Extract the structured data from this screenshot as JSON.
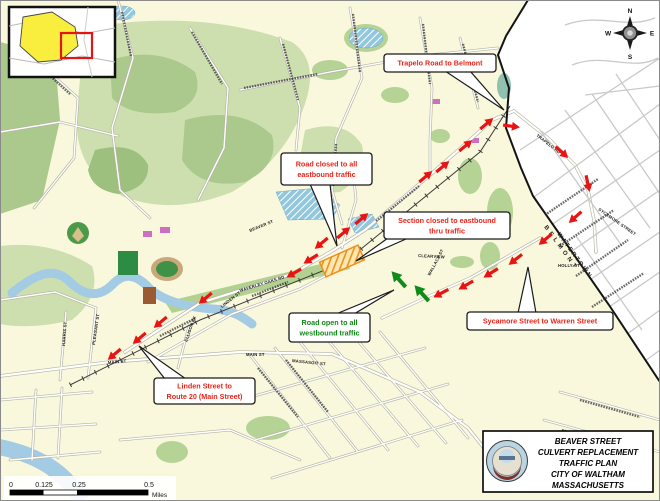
{
  "colors": {
    "land": "#faf8dc",
    "belmont": "#ffffff",
    "water": "#a3cbe3",
    "arrow_red": "#e81414",
    "arrow_green": "#108a18",
    "callout_red": "#e8251a",
    "construction": "#ef8f1f"
  },
  "compass": {
    "n": "N",
    "e": "E",
    "s": "S",
    "w": "W"
  },
  "scale_bar": {
    "labels": [
      "0",
      "0.125",
      "0.25",
      "0.5"
    ],
    "unit": "Miles"
  },
  "title_block": {
    "lines": [
      "BEAVER STREET",
      "CULVERT REPLACEMENT",
      "TRAFFIC PLAN",
      "CITY OF WALTHAM",
      "MASSACHUSETTS"
    ]
  },
  "region_labels": [
    {
      "t": "BELMONT",
      "x": 544,
      "y": 227,
      "r": 54,
      "ls": 3.5
    },
    {
      "t": "WATERTOWN",
      "x": 557,
      "y": 234,
      "r": 54,
      "ls": 1.8
    }
  ],
  "street_labels": [
    {
      "t": "BEAVER ST",
      "x": 250,
      "y": 232,
      "r": -22
    },
    {
      "t": "WAVERLEY OAKS RD",
      "x": 240,
      "y": 292,
      "r": -17
    },
    {
      "t": "MAIN ST",
      "x": 108,
      "y": 364,
      "r": -5
    },
    {
      "t": "MAIN ST",
      "x": 246,
      "y": 356,
      "r": 0
    },
    {
      "t": "MASSASOIT ST",
      "x": 292,
      "y": 362,
      "r": 6
    },
    {
      "t": "PLEASANT ST",
      "x": 95,
      "y": 345,
      "r": -82
    },
    {
      "t": "HARRIS ST",
      "x": 65,
      "y": 346,
      "r": -86
    },
    {
      "t": "ELLISON PK",
      "x": 187,
      "y": 342,
      "r": -70
    },
    {
      "t": "LINDEN ST",
      "x": 222,
      "y": 308,
      "r": -38
    },
    {
      "t": "TRAPELO RD",
      "x": 536,
      "y": 136,
      "r": 38
    },
    {
      "t": "SYCAMORE STREET",
      "x": 598,
      "y": 210,
      "r": 35
    },
    {
      "t": "HOLLY ST",
      "x": 558,
      "y": 267,
      "r": 0
    },
    {
      "t": "CLEARVIEW",
      "x": 418,
      "y": 257,
      "r": 3
    },
    {
      "t": "WALLACE ST",
      "x": 430,
      "y": 276,
      "r": -62
    }
  ],
  "callouts": [
    {
      "id": "trapelo-road-to-belmont",
      "lines": [
        "Trapelo Road to Belmont"
      ],
      "x": 384,
      "y": 54,
      "w": 112,
      "h": 18,
      "color": "#e8251a",
      "tail": "445,71 470,71 504,110"
    },
    {
      "id": "road-closed-eastbound",
      "lines": [
        "Road closed to all",
        "eastbound traffic"
      ],
      "x": 281,
      "y": 153,
      "w": 91,
      "h": 32,
      "color": "#e8251a",
      "tail": "310,184 330,184 337,246"
    },
    {
      "id": "section-closed-eastbound",
      "lines": [
        "Section closed to eastbound",
        "thru traffic"
      ],
      "x": 384,
      "y": 212,
      "w": 126,
      "h": 27,
      "color": "#e8251a",
      "tail": "388,238 406,239 356,261"
    },
    {
      "id": "road-open-westbound",
      "lines": [
        "Road open to all",
        "westbound traffic"
      ],
      "x": 289,
      "y": 313,
      "w": 81,
      "h": 29,
      "color": "#108a18",
      "tail": "336,314 354,314 394,290"
    },
    {
      "id": "sycamore-to-warren",
      "lines": [
        "Sycamore Street to Warren Street"
      ],
      "x": 467,
      "y": 312,
      "w": 146,
      "h": 18,
      "color": "#e8251a",
      "tail": "518,313 536,313 528,267"
    },
    {
      "id": "linden-to-route20",
      "lines": [
        "Linden Street to",
        "Route 20 (Main Street)"
      ],
      "x": 154,
      "y": 378,
      "w": 101,
      "h": 26,
      "color": "#e8251a",
      "tail": "165,379 186,379 139,346"
    }
  ],
  "arrows": {
    "red": [
      [
        348,
        229,
        -40
      ],
      [
        366,
        215,
        -40
      ],
      [
        430,
        173,
        -40
      ],
      [
        447,
        163,
        -40
      ],
      [
        470,
        142,
        -40
      ],
      [
        491,
        120,
        -40
      ],
      [
        517,
        127,
        8
      ],
      [
        566,
        156,
        42
      ],
      [
        589,
        189,
        78
      ],
      [
        571,
        221,
        138
      ],
      [
        541,
        243,
        140
      ],
      [
        511,
        263,
        142
      ],
      [
        486,
        276,
        148
      ],
      [
        461,
        288,
        150
      ],
      [
        436,
        296,
        152
      ],
      [
        317,
        247,
        140
      ],
      [
        306,
        262,
        148
      ],
      [
        289,
        276,
        150
      ],
      [
        201,
        302,
        140
      ],
      [
        156,
        326,
        140
      ],
      [
        135,
        342,
        140
      ],
      [
        110,
        358,
        140
      ]
    ],
    "green": [
      [
        394,
        274,
        228
      ],
      [
        417,
        288,
        228
      ]
    ]
  }
}
